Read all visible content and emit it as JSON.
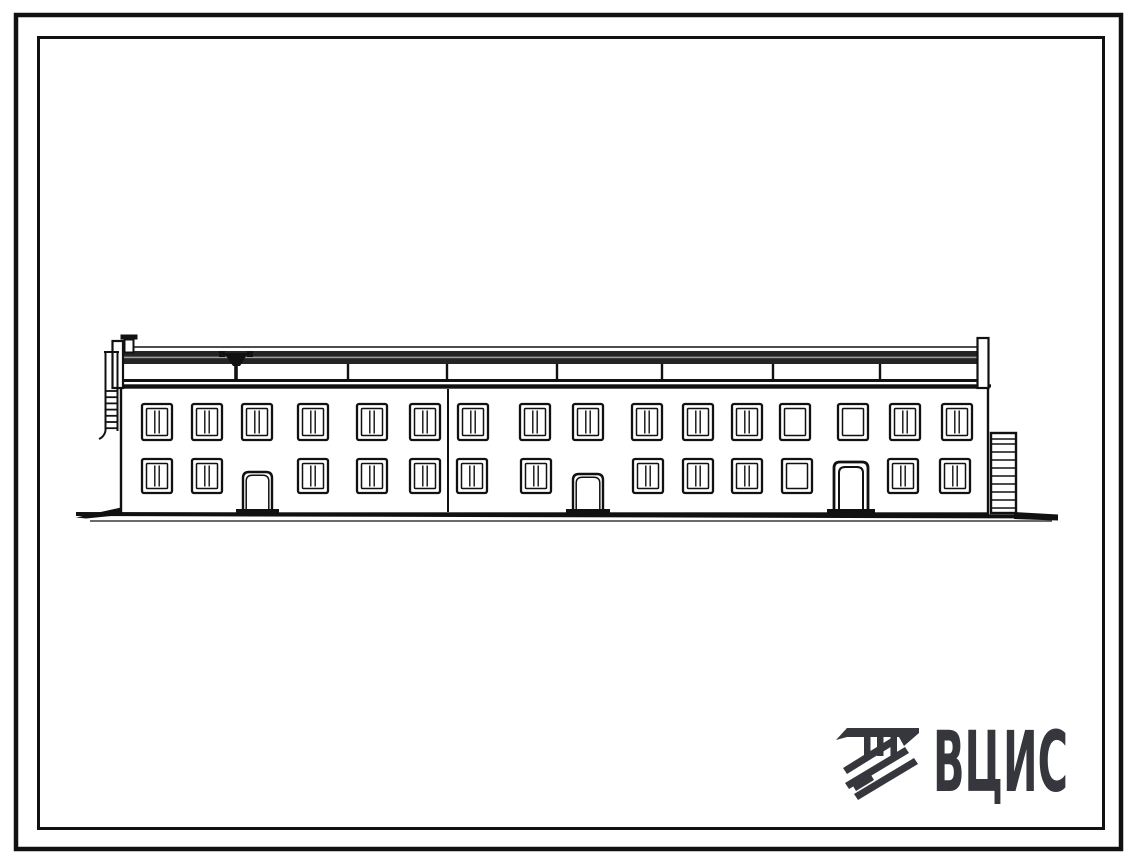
{
  "page": {
    "background": "#ffffff"
  },
  "frames": {
    "outer": {
      "x": 16,
      "y": 15,
      "w": 1105,
      "h": 834,
      "stroke_width": 4.5,
      "color": "#0d0d0d"
    },
    "inner": {
      "x": 38.5,
      "y": 37.5,
      "w": 1065,
      "h": 791,
      "stroke_width": 3,
      "color": "#0d0d0d"
    }
  },
  "logo": {
    "text": "ВЦИС",
    "color": "#36363d"
  },
  "drawing": {
    "ink": "#111111",
    "building": {
      "left": 121,
      "right": 988,
      "wall_top": 387.5,
      "ground": 513,
      "joint_x": 448
    },
    "roof": {
      "top_line_y": 347,
      "band_top": 351,
      "band_height": 13,
      "tick_xs": [
        348,
        447,
        557,
        662,
        773,
        880
      ],
      "tick_top": 364,
      "tick_bottom": 380,
      "funnel_cx": 236
    },
    "windows": {
      "upper": {
        "y": 404,
        "w": 30,
        "h": 36,
        "xs": [
          142,
          192,
          242,
          298,
          357,
          410,
          458,
          520,
          573,
          632,
          683,
          732,
          780,
          838,
          890,
          942
        ],
        "plain_xs": [
          780,
          838
        ]
      },
      "lower": {
        "y": 459,
        "w": 30,
        "h": 34,
        "xs": [
          142,
          192,
          298,
          357,
          410,
          457,
          521,
          633,
          683,
          732,
          782,
          888,
          940
        ],
        "plain_xs": [
          782
        ]
      }
    },
    "doors": [
      {
        "x": 243,
        "w": 29,
        "top": 472,
        "heavy": false
      },
      {
        "x": 573,
        "w": 30,
        "top": 474,
        "heavy": false
      },
      {
        "x": 834,
        "w": 34,
        "top": 462,
        "heavy": true
      }
    ],
    "ladder": {
      "rail_x1": 105.5,
      "rail_x2": 117.5,
      "top": 352,
      "bottom": 431,
      "rung_top": 391,
      "rung_step": 6.2,
      "rung_count": 7
    },
    "annex": {
      "x": 991,
      "w": 25,
      "top": 433,
      "bottom": 513,
      "rung_top": 444,
      "rung_step": 8,
      "rung_count": 9
    }
  }
}
